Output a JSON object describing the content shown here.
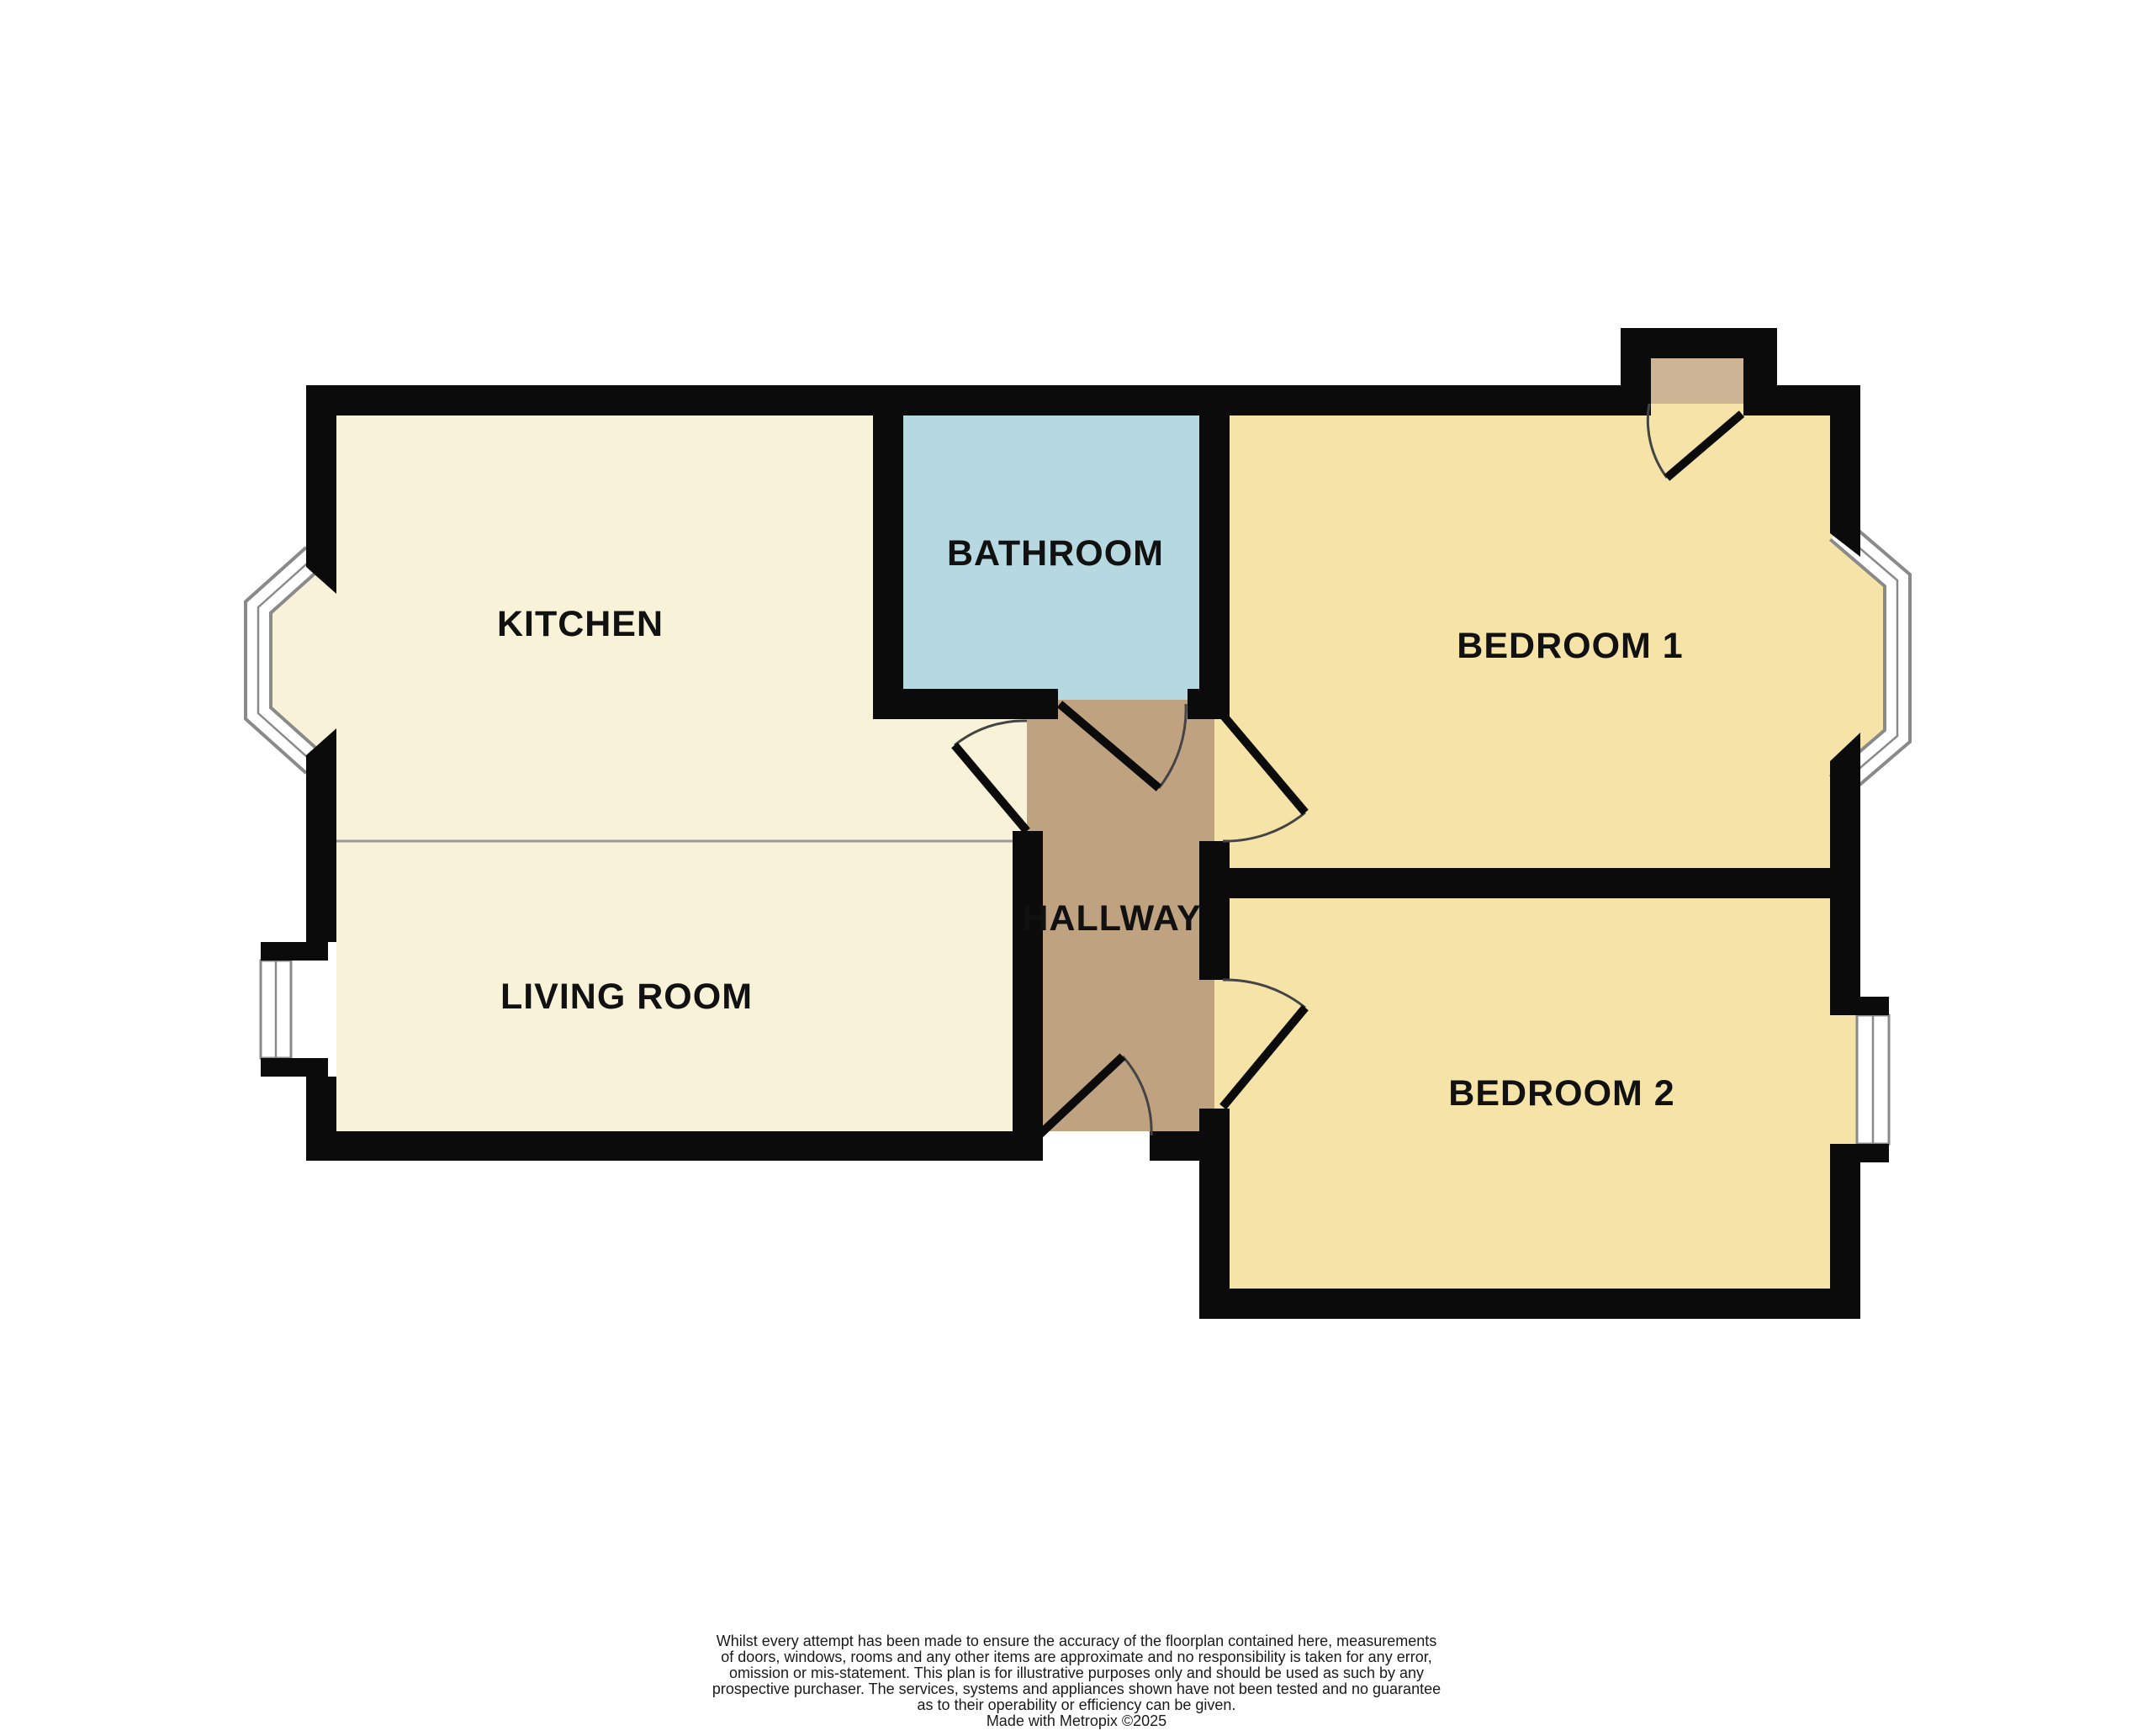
{
  "title": "Floorplan",
  "rooms": {
    "kitchen": {
      "label": "KITCHEN"
    },
    "bathroom": {
      "label": "BATHROOM"
    },
    "bedroom1": {
      "label": "BEDROOM 1"
    },
    "hallway": {
      "label": "HALLWAY"
    },
    "living_room": {
      "label": "LIVING ROOM"
    },
    "bedroom2": {
      "label": "BEDROOM 2"
    }
  },
  "colors": {
    "wall": "#0b0b0b",
    "kitchen_living_floor": "#F8F2D9",
    "bedroom_floor": "#F6E3A7",
    "bathroom_floor": "#B6D8E1",
    "hallway_floor": "#BFA380",
    "door_threshold": "#CDB494",
    "window_frame_gray": "#8a8a8a",
    "window_glass_white": "#ffffff",
    "room_divider_line": "#999999",
    "door_arc": "#444444",
    "label_text": "#111111",
    "disclaimer_text": "#1a1a1a"
  },
  "disclaimer": {
    "lines": [
      "Whilst every attempt has been made to ensure the accuracy of the floorplan contained here, measurements",
      "of doors, windows, rooms and any other items are approximate and no responsibility is taken for any error,",
      "omission or mis-statement. This plan is for illustrative purposes only and should be used as such by any",
      "prospective purchaser. The services, systems and appliances shown have not been tested and no guarantee",
      "as to their operability or efficiency can be given."
    ],
    "credit": "Made with Metropix ©2025"
  }
}
